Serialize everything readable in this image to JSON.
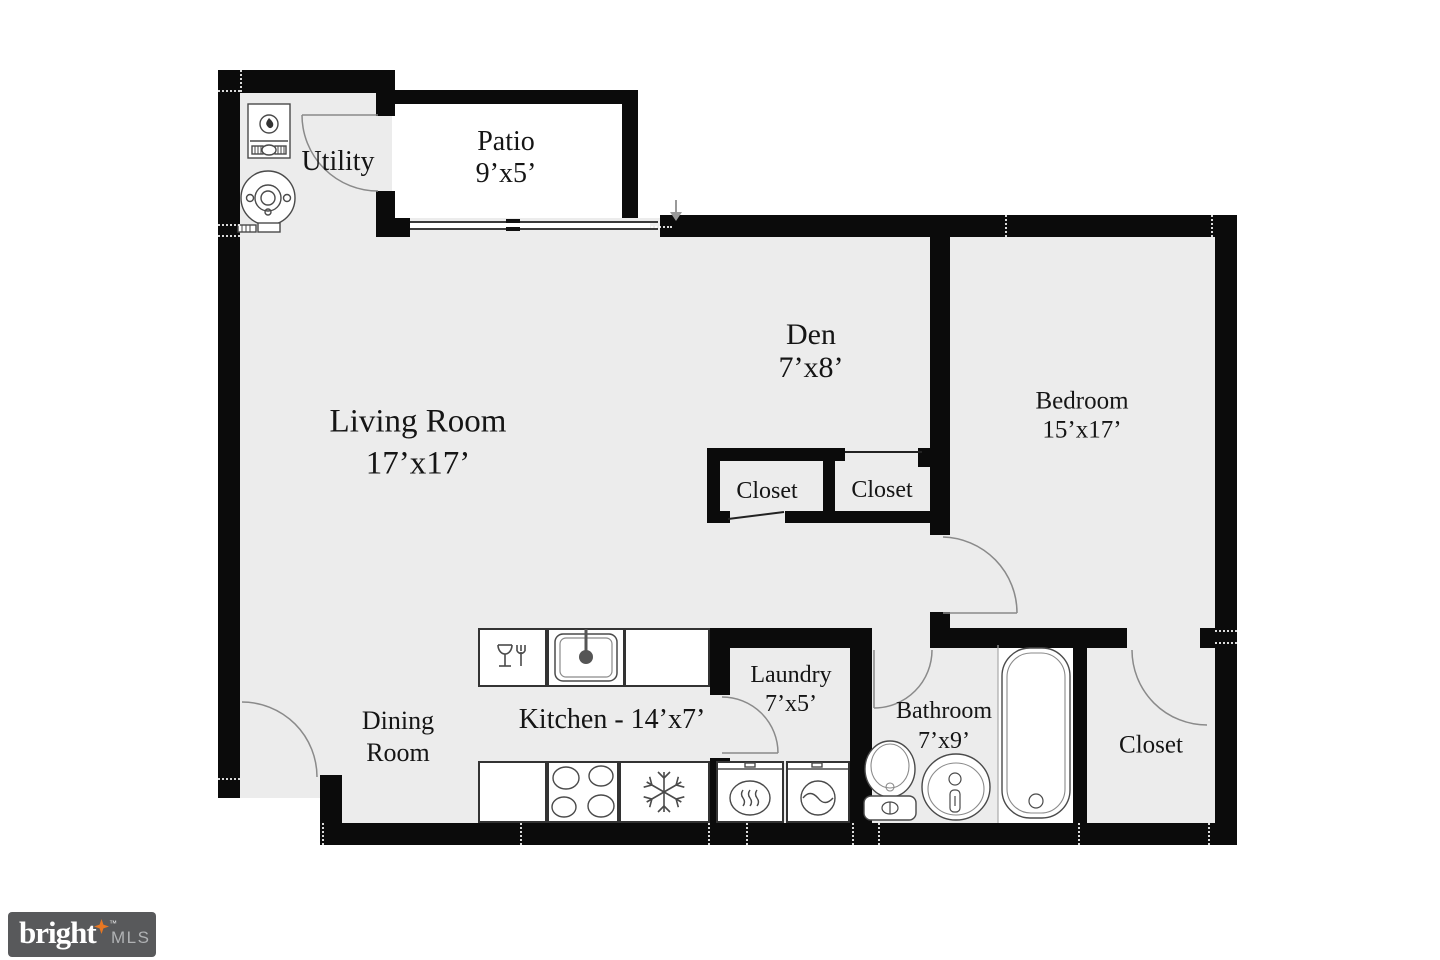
{
  "rooms": {
    "utility": {
      "name": "Utility"
    },
    "patio": {
      "name": "Patio",
      "dims": "9’x5’"
    },
    "living": {
      "name": "Living Room",
      "dims": "17’x17’"
    },
    "den": {
      "name": "Den",
      "dims": "7’x8’"
    },
    "bedroom": {
      "name": "Bedroom",
      "dims": "15’x17’"
    },
    "closet_hall_left": {
      "name": "Closet"
    },
    "closet_hall_right": {
      "name": "Closet"
    },
    "dining": {
      "line1": "Dining",
      "line2": "Room"
    },
    "kitchen": {
      "name": "Kitchen - 14’x7’"
    },
    "laundry": {
      "name": "Laundry",
      "dims": "7’x5’"
    },
    "bathroom": {
      "name": "Bathroom",
      "dims": "7’x9’"
    },
    "closet_bedroom": {
      "name": "Closet"
    }
  },
  "fixtures": {
    "utility": [
      "furnace-icon",
      "water-heater-icon"
    ],
    "kitchen": [
      "dishwasher-icon",
      "sink-icon",
      "stove-icon",
      "refrigerator-icon"
    ],
    "laundry": [
      "dryer-icon",
      "washer-icon"
    ],
    "bathroom": [
      "toilet-icon",
      "vanity-sink-icon",
      "bathtub-icon"
    ]
  },
  "logo": {
    "brand": "bright",
    "tm": "™",
    "suffix": "MLS",
    "star_color": "#e87722"
  },
  "colors": {
    "wall": "#0b0b0b",
    "floor": "#ececec",
    "fixture_line": "#4a4a4a",
    "door_arc": "#8a8a8a",
    "logo_bg": "#58595b",
    "logo_text": "#ffffff",
    "logo_mls": "#b0b2b4"
  }
}
